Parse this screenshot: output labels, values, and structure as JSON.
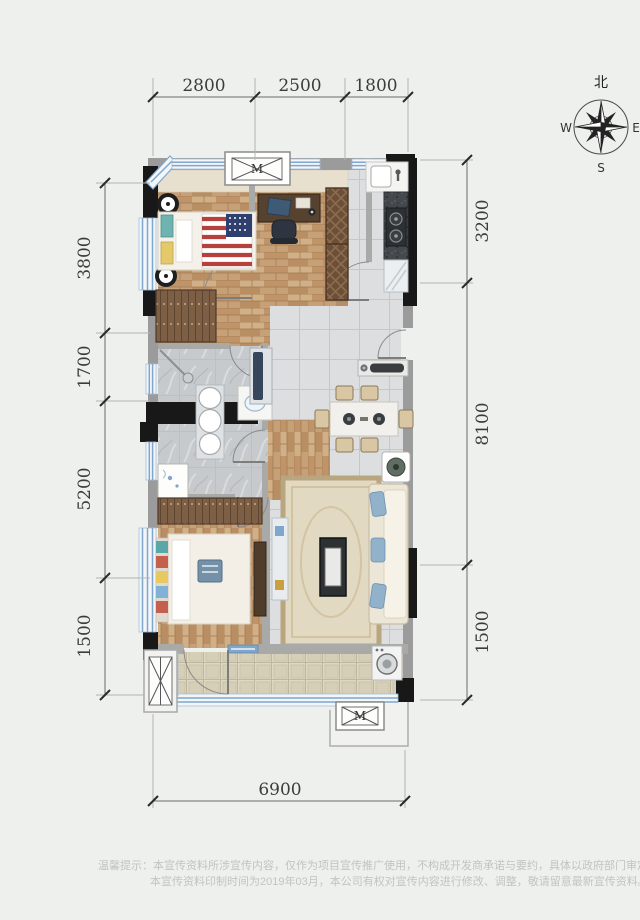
{
  "plan_type": "residential-floor-plan",
  "dims": {
    "top": [
      "2800",
      "2500",
      "1800"
    ],
    "left": [
      "3800",
      "1700",
      "5200",
      "1500"
    ],
    "right": [
      "3200",
      "8100",
      "1500"
    ],
    "bottom": [
      "6900"
    ]
  },
  "compass": {
    "north": "北",
    "west": "W",
    "east": "E",
    "south": "S"
  },
  "markers": {
    "duct": "M"
  },
  "disclaimer": {
    "line1": "温馨提示：本宣传资料所涉宣传内容，仅作为项目宣传推广使用，不构成开发商承诺与要约，具体以政府部门审定的规划设计文件及商品房买卖合同",
    "line2": "本宣传资料印制时间为2019年03月，本公司有权对宣传内容进行修改、调整，敬请留意最新宣传资料。"
  },
  "colors": {
    "background": "#eef0ee",
    "wall_black": "#181818",
    "wall_gray": "#9b9b9b",
    "window_blue": "#7fa6cd",
    "wood_floor": "#c6a077",
    "tile_gray": "#dcdedf",
    "marble_bath": "#c6cacd",
    "balcony_tile": "#ded7c1",
    "counter_granite": "#45494d",
    "flag_red": "#b5413c",
    "flag_blue": "#30406e",
    "pillow_blue": "#92b2cb",
    "rug_beige": "#e2d9c2"
  }
}
